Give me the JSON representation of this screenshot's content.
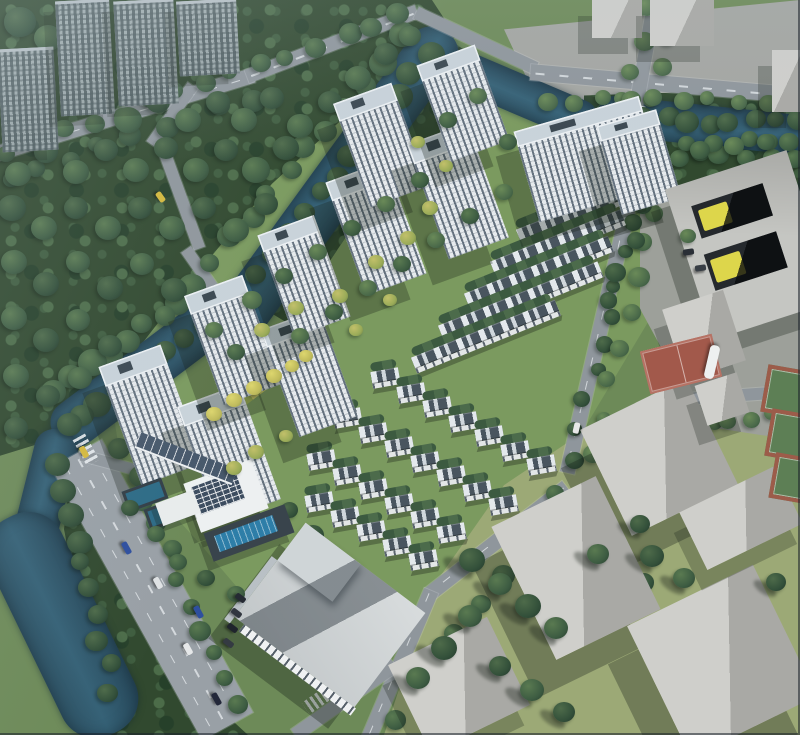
{
  "scene": {
    "label": "Aerial perspective rendering of a residential masterplan: white high-rise apartment towers and rows of slate-roofed townhouses set in green landscaping, bordered by a teal canal, a tree-lined boulevard with cars, a clubhouse with solar roof and swimming pool, and surrounding gray context massing blocks with sports courts",
    "width": 800,
    "height": 735
  },
  "palette": {
    "grass_base": "#6d8a58",
    "site_green": "#7b9a5f",
    "se_grass": "#9ca976",
    "pavement": "#9da09a",
    "pavement2": "#a4a6a2",
    "shadow": "rgba(22,32,24,0.34)",
    "tree_colors": [
      {
        "l": "#4e6b4a",
        "b": "#33503a",
        "d": "#22372a"
      },
      {
        "l": "#5a7a51",
        "b": "#3d5c42",
        "d": "#283f2e"
      },
      {
        "l": "#6a8a58",
        "b": "#4b6a4a",
        "d": "#31503a"
      },
      {
        "l": "#c2c06a",
        "b": "#9aab58",
        "d": "#6c8046"
      },
      {
        "l": "#ddd66e",
        "b": "#c0bb5c",
        "d": "#8f9a4a"
      }
    ]
  },
  "zones": [
    {
      "name": "site-lawn",
      "clip": "polygon(13% 48%,15% 40%,25% 15%,33% 9%,45% 4%,57% 9%,70% 17%,82% 26%,82% 42%,71% 62%,57% 80%,48% 88%,36% 88%,25% 74%,15% 62%)",
      "fill": "#7b9a5f"
    },
    {
      "name": "southeast-grass",
      "clip": "polygon(48% 100%,54% 80%,63% 66%,74% 58%,88% 55%,100% 55%,100% 100%)",
      "fill": "#9ca976"
    },
    {
      "name": "east-pavement",
      "clip": "polygon(80% 19%,100% 16%,100% 60%,88% 58%,80% 42%)",
      "fill": "#9da09a"
    },
    {
      "name": "topright-pavement",
      "clip": "polygon(63% 4%,100% 0%,100% 17%,80% 19%,66% 11%)",
      "fill": "#a4a6a2"
    },
    {
      "name": "forest-west",
      "clip": "polygon(0% 0%,54% 0%,57% 5%,46% 13%,34% 25%,24% 38%,14% 52%,6% 60%,0% 62%)",
      "forest": true
    },
    {
      "name": "forest-riverbank",
      "clip": "polygon(57% 6%,62% 10%,44% 31%,36% 44%,30% 40%,40% 25%)",
      "forest": true
    },
    {
      "name": "forest-canal",
      "clip": "polygon(73% 13%,100% 12%,100% 26%,82% 25%,73% 20%)",
      "forest": true
    },
    {
      "name": "forest-bottomleft",
      "clip": "polygon(9% 62%,14% 64%,29% 98%,31% 100%,13% 100%,8% 72%)",
      "forest": true
    }
  ],
  "water": [
    [
      338,
      182,
      370,
      52,
      126
    ],
    [
      148,
      368,
      230,
      48,
      143
    ],
    [
      44,
      498,
      140,
      44,
      104
    ],
    [
      62,
      625,
      240,
      80,
      64
    ],
    [
      702,
      125,
      210,
      40,
      6
    ],
    [
      521,
      95,
      162,
      40,
      23
    ]
  ],
  "roads": [
    [
      125,
      114,
      268,
      15,
      -17,
      1
    ],
    [
      332,
      44,
      182,
      14,
      -21,
      1
    ],
    [
      476,
      40,
      132,
      13,
      25,
      0
    ],
    [
      666,
      84,
      272,
      16,
      5,
      1
    ],
    [
      638,
      96,
      198,
      14,
      100,
      0
    ],
    [
      600,
      330,
      292,
      15,
      103,
      1
    ],
    [
      498,
      540,
      174,
      15,
      142,
      1
    ],
    [
      400,
      664,
      160,
      15,
      113,
      1
    ],
    [
      152,
      590,
      312,
      58,
      61,
      3
    ],
    [
      172,
      115,
      72,
      12,
      125,
      0
    ],
    [
      180,
      195,
      114,
      12,
      70,
      0
    ],
    [
      206,
      278,
      70,
      12,
      55,
      0
    ],
    [
      112,
      463,
      64,
      11,
      15,
      0
    ],
    [
      345,
      700,
      122,
      14,
      145,
      0
    ],
    [
      728,
      396,
      152,
      12,
      -4,
      0
    ]
  ],
  "crosswalks": [
    [
      86,
      450,
      61
    ],
    [
      318,
      700,
      145
    ],
    [
      636,
      120,
      100
    ]
  ],
  "garden_strip": {
    "x": 200,
    "y": 372,
    "w": 126,
    "h": 18,
    "a": -37
  },
  "towers": [
    [
      118,
      352,
      66,
      126,
      -20
    ],
    [
      196,
      392,
      66,
      122,
      -20
    ],
    [
      202,
      282,
      62,
      116,
      -20
    ],
    [
      278,
      316,
      62,
      114,
      -20
    ],
    [
      274,
      222,
      60,
      108,
      -20
    ],
    [
      344,
      168,
      64,
      120,
      -20
    ],
    [
      350,
      90,
      62,
      110,
      -20
    ],
    [
      426,
      130,
      64,
      122,
      -20
    ],
    [
      432,
      52,
      62,
      102,
      -20
    ],
    [
      524,
      112,
      130,
      94,
      -16
    ],
    [
      608,
      116,
      62,
      92,
      -16
    ]
  ],
  "bg_towers": [
    [
      0,
      48,
      56,
      100
    ],
    [
      58,
      0,
      54,
      112
    ],
    [
      116,
      0,
      60,
      102
    ],
    [
      178,
      0,
      60,
      72
    ]
  ],
  "slabs": [
    [
      592,
      0,
      50,
      38,
      0,
      0
    ],
    [
      650,
      0,
      64,
      46,
      0,
      0
    ],
    [
      772,
      50,
      28,
      62,
      0,
      0
    ],
    [
      600,
      398,
      118,
      118,
      -26,
      1
    ],
    [
      518,
      494,
      116,
      148,
      -26,
      1
    ],
    [
      652,
      588,
      140,
      146,
      -26,
      1
    ],
    [
      404,
      636,
      110,
      98,
      -26,
      0
    ],
    [
      688,
      486,
      106,
      64,
      -26,
      0
    ]
  ],
  "rows_n": {
    "a": -22,
    "rows": [
      [
        550,
        208,
        80
      ],
      [
        520,
        240,
        112
      ],
      [
        494,
        272,
        140
      ],
      [
        468,
        304,
        155
      ],
      [
        442,
        336,
        172
      ],
      [
        415,
        368,
        155
      ]
    ]
  },
  "bands_s": {
    "a": -10,
    "bw": 28,
    "step": [
      26,
      14.5
    ],
    "bands": [
      [
        372,
        382,
        7
      ],
      [
        334,
        422,
        7
      ],
      [
        308,
        464,
        6
      ],
      [
        306,
        506,
        5
      ]
    ]
  },
  "school": {
    "x": 686,
    "y": 166,
    "w": 128,
    "h": 158,
    "a": -18,
    "courts": [
      {
        "l": "16%",
        "t": "15%",
        "w": "58%",
        "h": "22%"
      },
      {
        "l": "13%",
        "t": "47%",
        "w": "60%",
        "h": "24%"
      }
    ]
  },
  "annex": [
    [
      672,
      298,
      64,
      74,
      -18
    ],
    [
      700,
      378,
      44,
      42,
      -18
    ]
  ],
  "courts_red": [
    [
      644,
      342,
      74,
      44,
      -14
    ]
  ],
  "courts_green": [
    [
      764,
      368,
      40,
      40,
      10
    ],
    [
      768,
      412,
      40,
      40,
      10
    ],
    [
      772,
      456,
      40,
      38,
      10
    ]
  ],
  "clubhouse": {
    "main": [
      190,
      470,
      72,
      52,
      -20
    ],
    "pool": [
      206,
      518,
      86,
      30,
      -20
    ],
    "canopy": [
      134,
      450,
      104,
      15,
      21
    ],
    "mini_pools": [
      [
        124,
        484,
        36,
        16,
        -20
      ],
      [
        146,
        502,
        36,
        16,
        -20
      ]
    ],
    "small": [
      158,
      496,
      40,
      24,
      -20
    ]
  },
  "commercial": {
    "x": 255,
    "y": 556,
    "w": 150,
    "h": 118,
    "a": 37
  },
  "tree_lines": [
    [
      428,
      52,
      238,
      296,
      13,
      12,
      0
    ],
    [
      398,
      38,
      214,
      262,
      11,
      12,
      1
    ],
    [
      222,
      310,
      66,
      428,
      10,
      12,
      0
    ],
    [
      196,
      286,
      58,
      392,
      9,
      12,
      1
    ],
    [
      62,
      462,
      112,
      692,
      10,
      11,
      0
    ],
    [
      124,
      448,
      236,
      708,
      11,
      10,
      1
    ],
    [
      8,
      150,
      402,
      16,
      15,
      10,
      1
    ],
    [
      10,
      176,
      254,
      100,
      9,
      10,
      0
    ],
    [
      600,
      118,
      796,
      124,
      10,
      10,
      0
    ],
    [
      606,
      152,
      792,
      160,
      9,
      10,
      1
    ],
    [
      544,
      100,
      792,
      102,
      10,
      9,
      2
    ],
    [
      636,
      196,
      572,
      462,
      10,
      9,
      0
    ],
    [
      560,
      496,
      398,
      716,
      9,
      10,
      1
    ],
    [
      654,
      210,
      592,
      452,
      8,
      9,
      2
    ],
    [
      658,
      178,
      606,
      300,
      5,
      10,
      0
    ],
    [
      252,
      464,
      388,
      636,
      8,
      10,
      0
    ],
    [
      690,
      428,
      792,
      414,
      6,
      9,
      2
    ],
    [
      648,
      10,
      622,
      128,
      5,
      9,
      2
    ],
    [
      670,
      12,
      648,
      126,
      5,
      9,
      2
    ],
    [
      690,
      146,
      792,
      140,
      6,
      9,
      1
    ],
    [
      566,
      518,
      648,
      586,
      5,
      10,
      0
    ]
  ],
  "trees_back": [
    [
      20,
      22,
      16,
      0
    ],
    [
      48,
      38,
      14,
      1
    ],
    [
      14,
      66,
      13,
      0
    ],
    [
      128,
      120,
      14,
      1
    ],
    [
      158,
      102,
      12,
      0
    ],
    [
      188,
      120,
      13,
      1
    ],
    [
      218,
      102,
      12,
      0
    ],
    [
      244,
      120,
      13,
      1
    ],
    [
      272,
      98,
      12,
      0
    ],
    [
      300,
      126,
      13,
      1
    ],
    [
      330,
      102,
      12,
      0
    ],
    [
      358,
      78,
      13,
      1
    ],
    [
      386,
      54,
      12,
      0
    ],
    [
      410,
      36,
      11,
      1
    ],
    [
      286,
      148,
      13,
      0
    ],
    [
      256,
      170,
      14,
      1
    ],
    [
      226,
      150,
      12,
      0
    ],
    [
      196,
      170,
      13,
      1
    ],
    [
      166,
      148,
      12,
      0
    ],
    [
      136,
      170,
      13,
      1
    ],
    [
      106,
      150,
      12,
      0
    ],
    [
      76,
      172,
      13,
      1
    ],
    [
      46,
      152,
      12,
      0
    ],
    [
      18,
      174,
      13,
      1
    ],
    [
      12,
      208,
      14,
      0
    ],
    [
      44,
      228,
      13,
      1
    ],
    [
      76,
      208,
      12,
      0
    ],
    [
      108,
      228,
      13,
      1
    ],
    [
      140,
      208,
      12,
      0
    ],
    [
      172,
      228,
      13,
      1
    ],
    [
      204,
      208,
      12,
      0
    ],
    [
      236,
      230,
      13,
      1
    ],
    [
      266,
      204,
      12,
      0
    ],
    [
      14,
      262,
      13,
      1
    ],
    [
      46,
      284,
      13,
      0
    ],
    [
      78,
      262,
      12,
      1
    ],
    [
      110,
      288,
      13,
      0
    ],
    [
      142,
      264,
      12,
      1
    ],
    [
      174,
      290,
      13,
      0
    ],
    [
      14,
      318,
      13,
      1
    ],
    [
      46,
      340,
      13,
      0
    ],
    [
      78,
      320,
      12,
      1
    ],
    [
      110,
      346,
      12,
      0
    ],
    [
      16,
      376,
      13,
      1
    ],
    [
      48,
      396,
      12,
      0
    ],
    [
      80,
      378,
      12,
      1
    ],
    [
      16,
      428,
      12,
      0
    ]
  ],
  "trees_front": [
    [
      252,
      300,
      10,
      2,
      0
    ],
    [
      284,
      276,
      9,
      1,
      0
    ],
    [
      318,
      252,
      9,
      2,
      0
    ],
    [
      352,
      228,
      9,
      1,
      0
    ],
    [
      386,
      204,
      9,
      2,
      0
    ],
    [
      420,
      180,
      9,
      1,
      0
    ],
    [
      300,
      336,
      9,
      2,
      0
    ],
    [
      334,
      312,
      9,
      1,
      0
    ],
    [
      368,
      288,
      9,
      2,
      0
    ],
    [
      402,
      264,
      9,
      1,
      0
    ],
    [
      436,
      240,
      9,
      2,
      0
    ],
    [
      470,
      216,
      9,
      1,
      0
    ],
    [
      504,
      192,
      9,
      2,
      0
    ],
    [
      236,
      352,
      9,
      1,
      0
    ],
    [
      214,
      330,
      9,
      2,
      0
    ],
    [
      448,
      120,
      9,
      1,
      0
    ],
    [
      478,
      96,
      9,
      2,
      0
    ],
    [
      508,
      142,
      9,
      1,
      0
    ],
    [
      262,
      330,
      8,
      3,
      0
    ],
    [
      296,
      308,
      8,
      3,
      0
    ],
    [
      340,
      296,
      8,
      3,
      0
    ],
    [
      376,
      262,
      8,
      3,
      0
    ],
    [
      408,
      238,
      8,
      3,
      0
    ],
    [
      430,
      208,
      8,
      3,
      0
    ],
    [
      390,
      300,
      7,
      3,
      0
    ],
    [
      356,
      330,
      7,
      3,
      0
    ],
    [
      234,
      468,
      8,
      3,
      0
    ],
    [
      256,
      452,
      8,
      3,
      0
    ],
    [
      286,
      436,
      7,
      3,
      0
    ],
    [
      418,
      142,
      7,
      3,
      0
    ],
    [
      446,
      166,
      7,
      3,
      0
    ],
    [
      214,
      414,
      8,
      4,
      0
    ],
    [
      234,
      400,
      8,
      4,
      0
    ],
    [
      254,
      388,
      8,
      4,
      0
    ],
    [
      274,
      376,
      8,
      4,
      0
    ],
    [
      292,
      366,
      7,
      4,
      0
    ],
    [
      306,
      356,
      7,
      4,
      0
    ],
    [
      156,
      534,
      9,
      1,
      0
    ],
    [
      130,
      508,
      9,
      0,
      0
    ],
    [
      178,
      562,
      9,
      1,
      0
    ],
    [
      206,
      578,
      9,
      0,
      0
    ],
    [
      236,
      594,
      9,
      1,
      0
    ],
    [
      472,
      560,
      13,
      0,
      1
    ],
    [
      500,
      584,
      12,
      1,
      1
    ],
    [
      528,
      606,
      13,
      0,
      1
    ],
    [
      556,
      628,
      12,
      1,
      1
    ],
    [
      470,
      616,
      12,
      1,
      1
    ],
    [
      444,
      648,
      13,
      0,
      1
    ],
    [
      418,
      678,
      12,
      1,
      1
    ],
    [
      500,
      666,
      11,
      0,
      1
    ],
    [
      532,
      690,
      12,
      1,
      1
    ],
    [
      564,
      712,
      11,
      0,
      1
    ],
    [
      652,
      556,
      12,
      0,
      1
    ],
    [
      684,
      578,
      11,
      1,
      1
    ],
    [
      598,
      554,
      11,
      1,
      1
    ],
    [
      640,
      524,
      10,
      0,
      1
    ],
    [
      776,
      582,
      10,
      0,
      1
    ],
    [
      700,
      150,
      10,
      1,
      0
    ],
    [
      734,
      146,
      10,
      2,
      0
    ],
    [
      766,
      142,
      9,
      1,
      0
    ],
    [
      688,
      236,
      8,
      2,
      0
    ]
  ],
  "cars": [
    [
      126,
      548,
      61,
      13,
      "#2e4f9e"
    ],
    [
      198,
      612,
      61,
      13,
      "#2e4f9e"
    ],
    [
      188,
      649,
      61,
      12,
      "#e6e8e9"
    ],
    [
      84,
      452,
      61,
      12,
      "#d6b93c"
    ],
    [
      216,
      699,
      61,
      13,
      "#23283a"
    ],
    [
      158,
      583,
      61,
      12,
      "#dfe2e4"
    ],
    [
      160,
      197,
      55,
      11,
      "#d6b93c"
    ],
    [
      576,
      428,
      -77,
      11,
      "#e8e8e8"
    ],
    [
      240,
      598,
      37,
      11,
      "#252a33"
    ],
    [
      236,
      613,
      37,
      11,
      "#31363f"
    ],
    [
      232,
      628,
      37,
      11,
      "#1f242c"
    ],
    [
      228,
      643,
      37,
      11,
      "#343a42"
    ],
    [
      688,
      252,
      -8,
      11,
      "#2a2f36"
    ],
    [
      700,
      268,
      -8,
      11,
      "#383e45"
    ]
  ],
  "bus": {
    "x": 712,
    "y": 362,
    "a": 103,
    "l": 34,
    "w": 10,
    "c": "#eef0f0"
  }
}
